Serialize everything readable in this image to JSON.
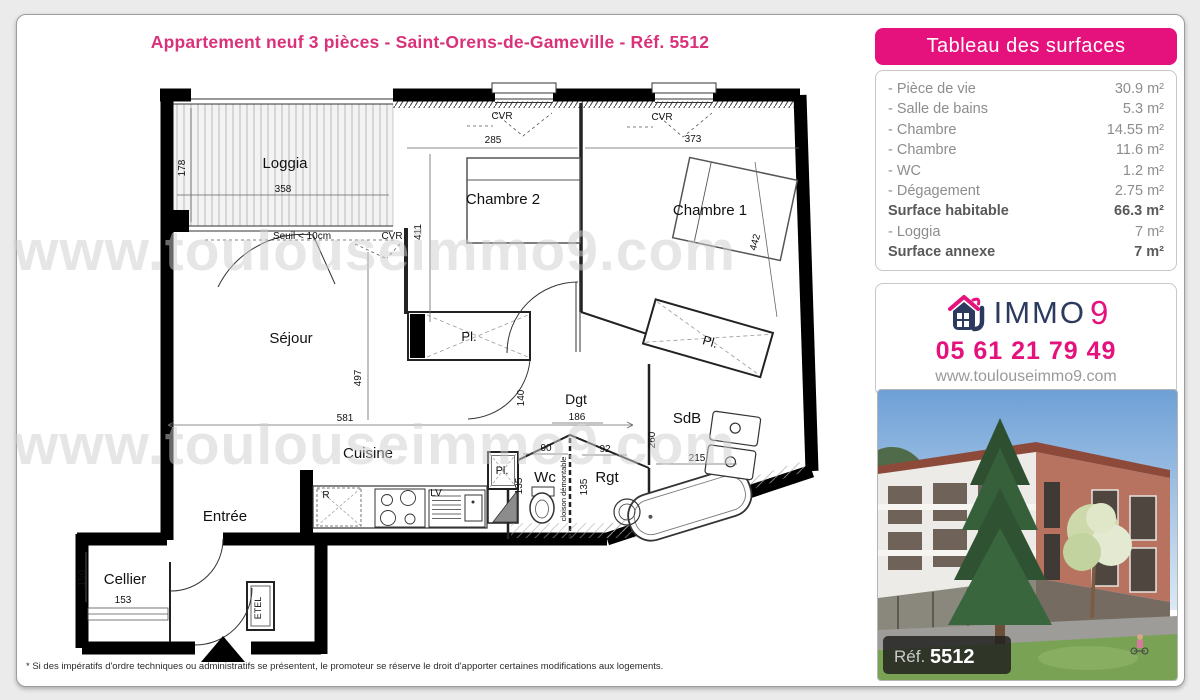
{
  "header": {
    "title": "Appartement neuf 3 pièces - Saint-Orens-de-Gameville - Réf. 5512",
    "title_color": "#d9327a"
  },
  "surfaces_panel": {
    "title": "Tableau des surfaces",
    "header_color": "#e5127d",
    "rows": [
      {
        "label": "- Pièce de vie",
        "value": "30.9 m²",
        "bold": false
      },
      {
        "label": "- Salle de bains",
        "value": "5.3 m²",
        "bold": false
      },
      {
        "label": "- Chambre",
        "value": "14.55 m²",
        "bold": false
      },
      {
        "label": "- Chambre",
        "value": "11.6 m²",
        "bold": false
      },
      {
        "label": "- WC",
        "value": "1.2 m²",
        "bold": false
      },
      {
        "label": "- Dégagement",
        "value": "2.75 m²",
        "bold": false
      },
      {
        "label": "Surface habitable",
        "value": "66.3 m²",
        "bold": true
      },
      {
        "label": "- Loggia",
        "value": "7 m²",
        "bold": false
      },
      {
        "label": "Surface annexe",
        "value": "7 m²",
        "bold": true
      }
    ]
  },
  "agency": {
    "brand_immo": "IMMO",
    "brand_9": "9",
    "phone": "05 61 21 79 49",
    "website": "www.toulouseimmo9.com",
    "navy": "#2b3a5e",
    "pink": "#e5127d"
  },
  "photo": {
    "ref_label": "Réf.",
    "ref_number": "5512"
  },
  "watermark": {
    "text": "www.toulouseimmo9.com"
  },
  "footer": {
    "note": "* Si des impératifs d'ordre techniques ou administratifs se présentent, le promoteur se réserve le droit d'apporter certaines modifications aux logements."
  },
  "floorplan": {
    "labels": [
      {
        "text": "Loggia",
        "x": 230,
        "y": 86,
        "size": 15
      },
      {
        "text": "178",
        "x": 130,
        "y": 86,
        "size": 10,
        "rot": -90
      },
      {
        "text": "358",
        "x": 228,
        "y": 110,
        "size": 10
      },
      {
        "text": "Seuil < 10cm",
        "x": 247,
        "y": 157,
        "size": 10
      },
      {
        "text": "CVR",
        "x": 337,
        "y": 157,
        "size": 10
      },
      {
        "text": "CVR",
        "x": 447,
        "y": 37,
        "size": 10
      },
      {
        "text": "285",
        "x": 438,
        "y": 61,
        "size": 10
      },
      {
        "text": "CVR",
        "x": 607,
        "y": 38,
        "size": 10
      },
      {
        "text": "373",
        "x": 638,
        "y": 60,
        "size": 10
      },
      {
        "text": "Chambre 2",
        "x": 448,
        "y": 122,
        "size": 15
      },
      {
        "text": "411",
        "x": 366,
        "y": 150,
        "size": 10,
        "rot": -90
      },
      {
        "text": "Chambre 1",
        "x": 655,
        "y": 133,
        "size": 15
      },
      {
        "text": "442",
        "x": 703,
        "y": 161,
        "size": 10,
        "rot": -75
      },
      {
        "text": "Séjour",
        "x": 236,
        "y": 261,
        "size": 15
      },
      {
        "text": "497",
        "x": 306,
        "y": 296,
        "size": 10,
        "rot": -90
      },
      {
        "text": "581",
        "x": 290,
        "y": 339,
        "size": 10
      },
      {
        "text": "Pl.",
        "x": 414,
        "y": 259,
        "size": 13
      },
      {
        "text": "Pl.",
        "x": 654,
        "y": 264,
        "size": 13,
        "rot": 16
      },
      {
        "text": "Dgt",
        "x": 521,
        "y": 322,
        "size": 14
      },
      {
        "text": "186",
        "x": 522,
        "y": 338,
        "size": 10
      },
      {
        "text": "140",
        "x": 469,
        "y": 316,
        "size": 10,
        "rot": -90
      },
      {
        "text": "90",
        "x": 491,
        "y": 369,
        "size": 10
      },
      {
        "text": "92",
        "x": 550,
        "y": 370,
        "size": 10
      },
      {
        "text": "SdB",
        "x": 632,
        "y": 341,
        "size": 15
      },
      {
        "text": "260",
        "x": 600,
        "y": 358,
        "size": 10,
        "rot": -90
      },
      {
        "text": "215",
        "x": 642,
        "y": 379,
        "size": 10
      },
      {
        "text": "Wc",
        "x": 490,
        "y": 400,
        "size": 15
      },
      {
        "text": "Rgt",
        "x": 552,
        "y": 400,
        "size": 15
      },
      {
        "text": "cloison démontable",
        "x": 511,
        "y": 407,
        "size": 7.5,
        "rot": -90
      },
      {
        "text": "135",
        "x": 467,
        "y": 404,
        "size": 10,
        "rot": -90
      },
      {
        "text": "135",
        "x": 532,
        "y": 405,
        "size": 10,
        "rot": -90
      },
      {
        "text": "Cuisine",
        "x": 313,
        "y": 376,
        "size": 15
      },
      {
        "text": "R",
        "x": 271,
        "y": 416,
        "size": 10
      },
      {
        "text": "LV",
        "x": 381,
        "y": 414,
        "size": 10
      },
      {
        "text": "Pl.",
        "x": 447,
        "y": 392,
        "size": 11
      },
      {
        "text": "Entrée",
        "x": 170,
        "y": 439,
        "size": 15
      },
      {
        "text": "Cellier",
        "x": 70,
        "y": 502,
        "size": 15
      },
      {
        "text": "150",
        "x": 30,
        "y": 496,
        "size": 10,
        "rot": -90
      },
      {
        "text": "153",
        "x": 68,
        "y": 521,
        "size": 10
      },
      {
        "text": "ETEL",
        "x": 206,
        "y": 526,
        "size": 9,
        "rot": -90
      }
    ]
  }
}
